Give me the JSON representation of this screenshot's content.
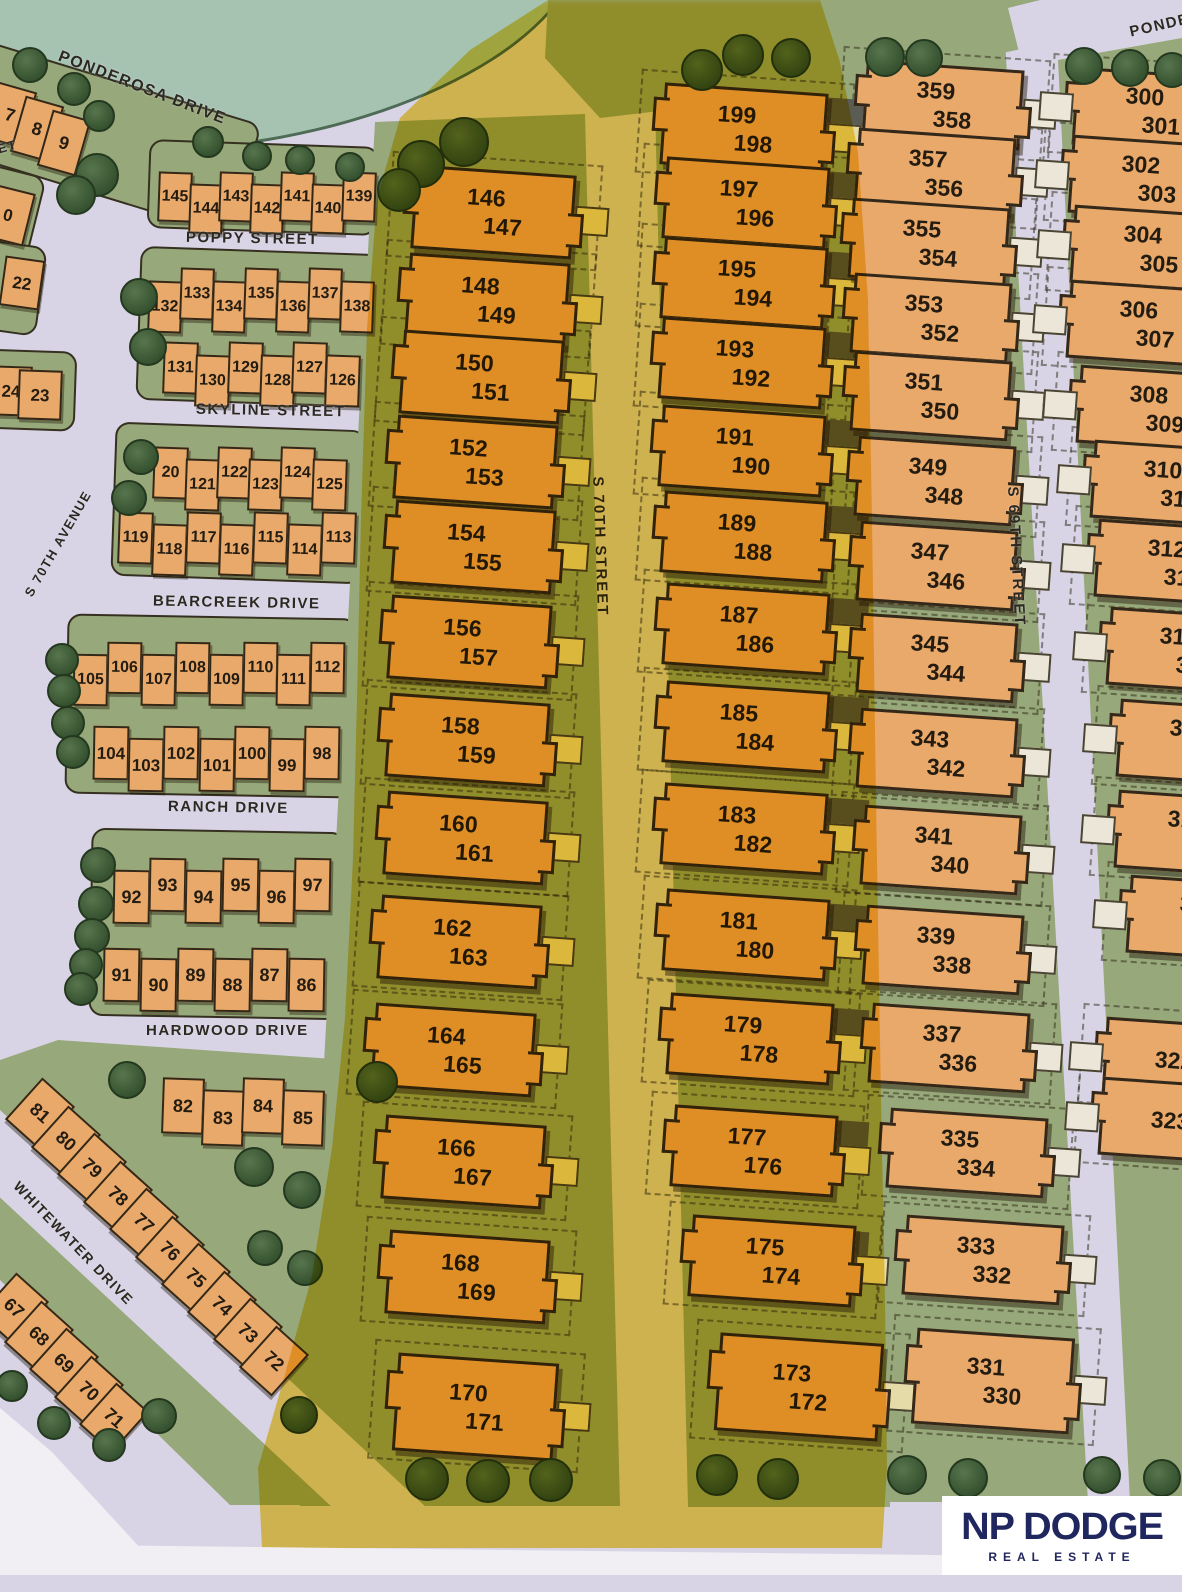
{
  "title": "Subdivision plat map with highlighted townhome lots",
  "streets": {
    "ponderosa": "PONDEROSA DRIVE",
    "ponderosa_partial": "PONDE",
    "poppy": "POPPY STREET",
    "skyline": "SKYLINE STREET",
    "bearcreek": "BEARCREEK DRIVE",
    "ranch": "RANCH DRIVE",
    "hardwood": "HARDWOOD DRIVE",
    "whitewater": "WHITEWATER DRIVE",
    "s70th_avenue": "S 70TH AVENUE",
    "s70th_street": "S 70TH STREET",
    "s69th_street": "S 69TH STREET",
    "street_partial": "ET"
  },
  "rows": {
    "row_789": [
      "7",
      "8",
      "9"
    ],
    "row_145": [
      "145",
      "144",
      "143",
      "142",
      "141",
      "140",
      "139"
    ],
    "row_132": [
      "132",
      "133",
      "134",
      "135",
      "136",
      "137",
      "138"
    ],
    "row_131": [
      "131",
      "130",
      "129",
      "128",
      "127",
      "126"
    ],
    "row_120": [
      "20",
      "121",
      "122",
      "123",
      "124",
      "125"
    ],
    "row_119": [
      "119",
      "118",
      "117",
      "116",
      "115",
      "114",
      "113"
    ],
    "row_105": [
      "105",
      "106",
      "107",
      "108",
      "109",
      "110",
      "111",
      "112"
    ],
    "row_104": [
      "104",
      "103",
      "102",
      "101",
      "100",
      "99",
      "98"
    ],
    "row_92": [
      "92",
      "93",
      "94",
      "95",
      "96",
      "97"
    ],
    "row_91": [
      "91",
      "90",
      "89",
      "88",
      "87",
      "86"
    ],
    "row_82": [
      "82",
      "83",
      "84",
      "85"
    ],
    "diag_81": [
      "81",
      "80",
      "79",
      "78",
      "77",
      "76",
      "75",
      "74",
      "73",
      "72"
    ],
    "diag_67": [
      "67",
      "68",
      "69",
      "70",
      "71"
    ],
    "edge": [
      "0",
      "22",
      "24",
      "23"
    ]
  },
  "columns": {
    "col_146": [
      [
        "146",
        "147"
      ],
      [
        "148",
        "149"
      ],
      [
        "150",
        "151"
      ],
      [
        "152",
        "153"
      ],
      [
        "154",
        "155"
      ],
      [
        "156",
        "157"
      ],
      [
        "158",
        "159"
      ],
      [
        "160",
        "161"
      ],
      [
        "162",
        "163"
      ],
      [
        "164",
        "165"
      ],
      [
        "166",
        "167"
      ],
      [
        "168",
        "169"
      ],
      [
        "170",
        "171"
      ]
    ],
    "col_199": [
      [
        "199",
        "198"
      ],
      [
        "197",
        "196"
      ],
      [
        "195",
        "194"
      ],
      [
        "193",
        "192"
      ],
      [
        "191",
        "190"
      ],
      [
        "189",
        "188"
      ],
      [
        "187",
        "186"
      ],
      [
        "185",
        "184"
      ],
      [
        "183",
        "182"
      ],
      [
        "181",
        "180"
      ],
      [
        "179",
        "178"
      ],
      [
        "177",
        "176"
      ],
      [
        "175",
        "174"
      ],
      [
        "173",
        "172"
      ]
    ],
    "col_359": [
      [
        "359",
        "358"
      ],
      [
        "357",
        "356"
      ],
      [
        "355",
        "354"
      ],
      [
        "353",
        "352"
      ],
      [
        "351",
        "350"
      ],
      [
        "349",
        "348"
      ],
      [
        "347",
        "346"
      ],
      [
        "345",
        "344"
      ],
      [
        "343",
        "342"
      ],
      [
        "341",
        "340"
      ],
      [
        "339",
        "338"
      ],
      [
        "337",
        "336"
      ],
      [
        "335",
        "334"
      ],
      [
        "333",
        "332"
      ],
      [
        "331",
        "330"
      ]
    ],
    "col_300": [
      [
        "300",
        "301"
      ],
      [
        "302",
        "303"
      ],
      [
        "304",
        "305"
      ],
      [
        "306",
        "307"
      ],
      [
        "308",
        "309"
      ],
      [
        "310",
        "311"
      ],
      [
        "312",
        "313"
      ],
      [
        "314",
        "315"
      ],
      [
        "316",
        "317"
      ],
      [
        "318",
        "319"
      ],
      [
        "320",
        "321"
      ],
      [
        "322"
      ],
      [
        "323"
      ]
    ]
  },
  "logo": {
    "name": "NP DODGE",
    "tagline": "REAL ESTATE"
  },
  "colors": {
    "highlight": "#f3cf3b",
    "logo_navy": "#20265e",
    "building_tan": "#e9a96b",
    "block_green": "#97a87a",
    "street_lavender": "#d8d4e6",
    "pond_teal": "#a6c3b2",
    "tree_green": "#35512f"
  }
}
